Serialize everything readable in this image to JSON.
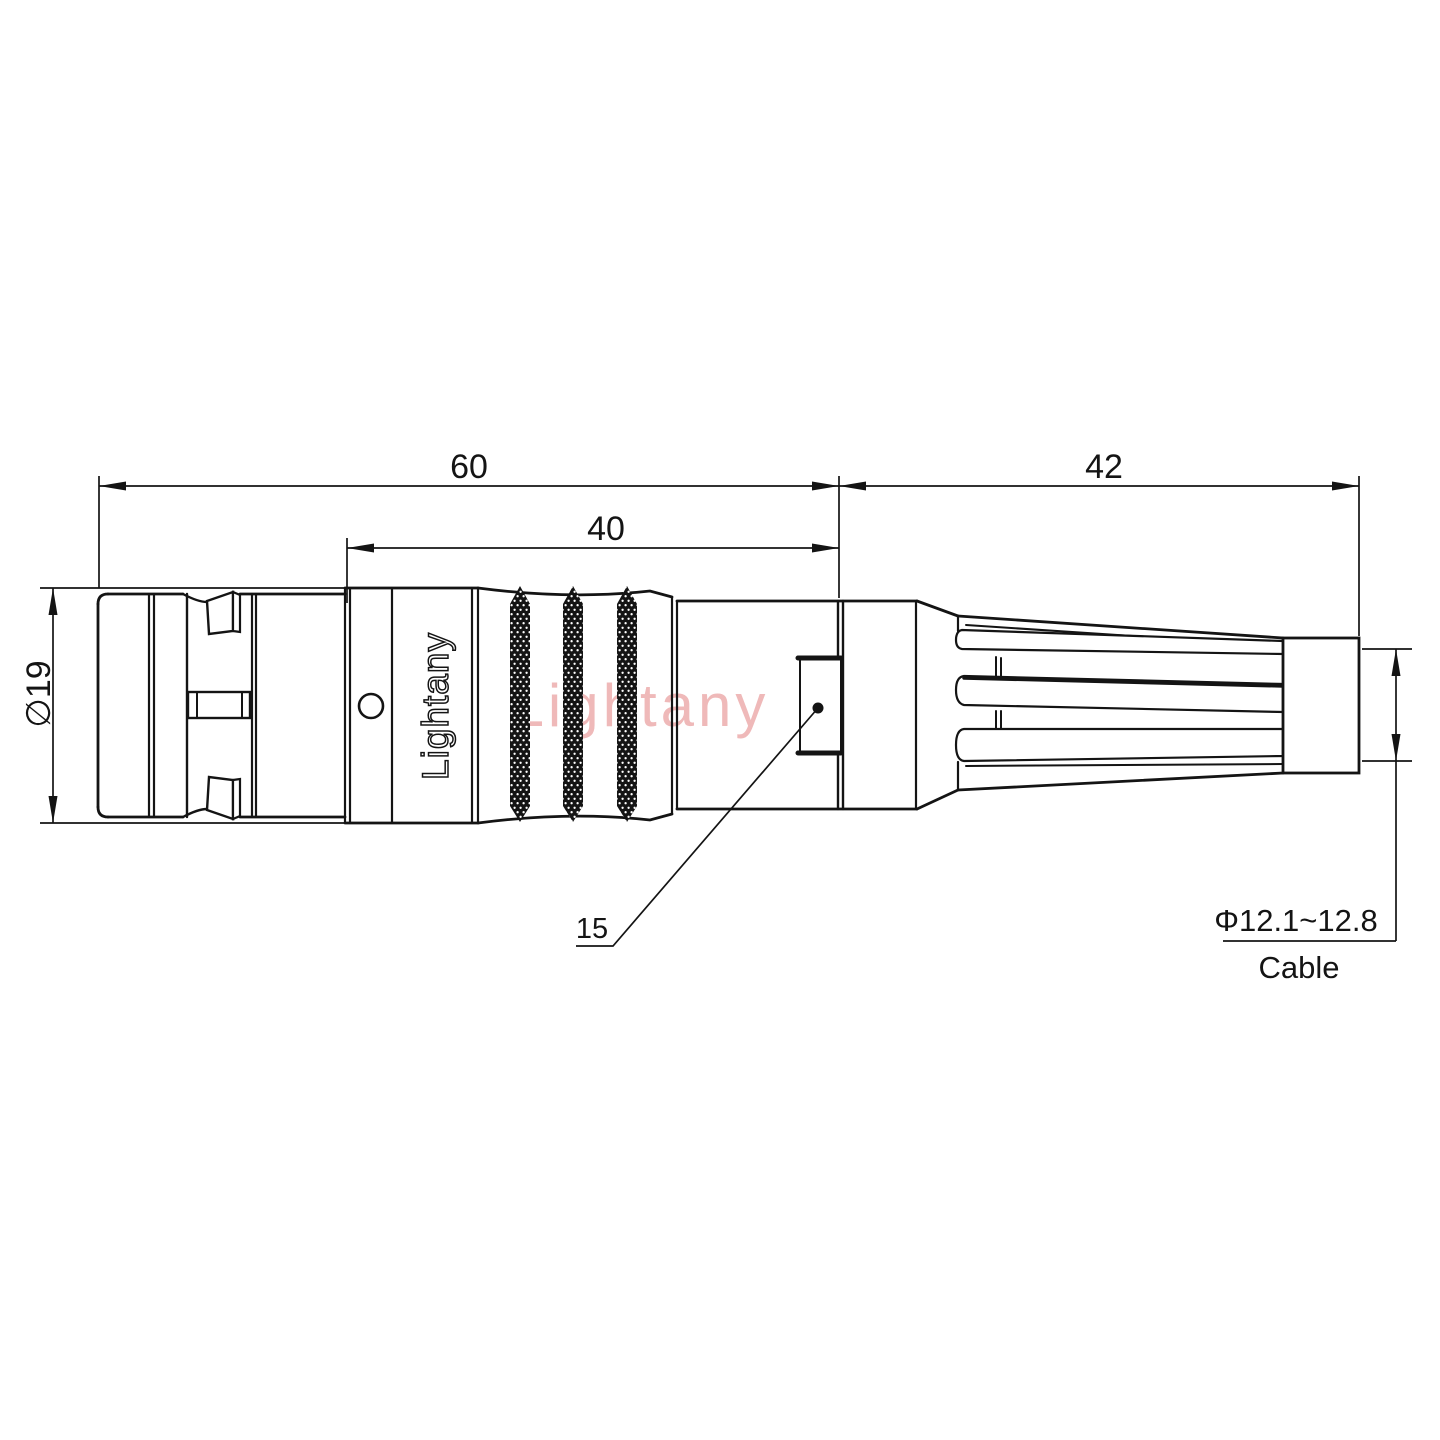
{
  "labels": {
    "dim_overall_length": "60",
    "dim_body_length": "40",
    "dim_boot_length": "42",
    "dim_shell_diameter": "∅19",
    "dim_latch_window": "15",
    "cable_range": "Φ12.1~12.8",
    "cable_word": "Cable",
    "engraving": "Lightany",
    "watermark": "Lightany"
  },
  "colors": {
    "line": "#141414",
    "watermark": "#efb9b9",
    "background": "#ffffff"
  }
}
